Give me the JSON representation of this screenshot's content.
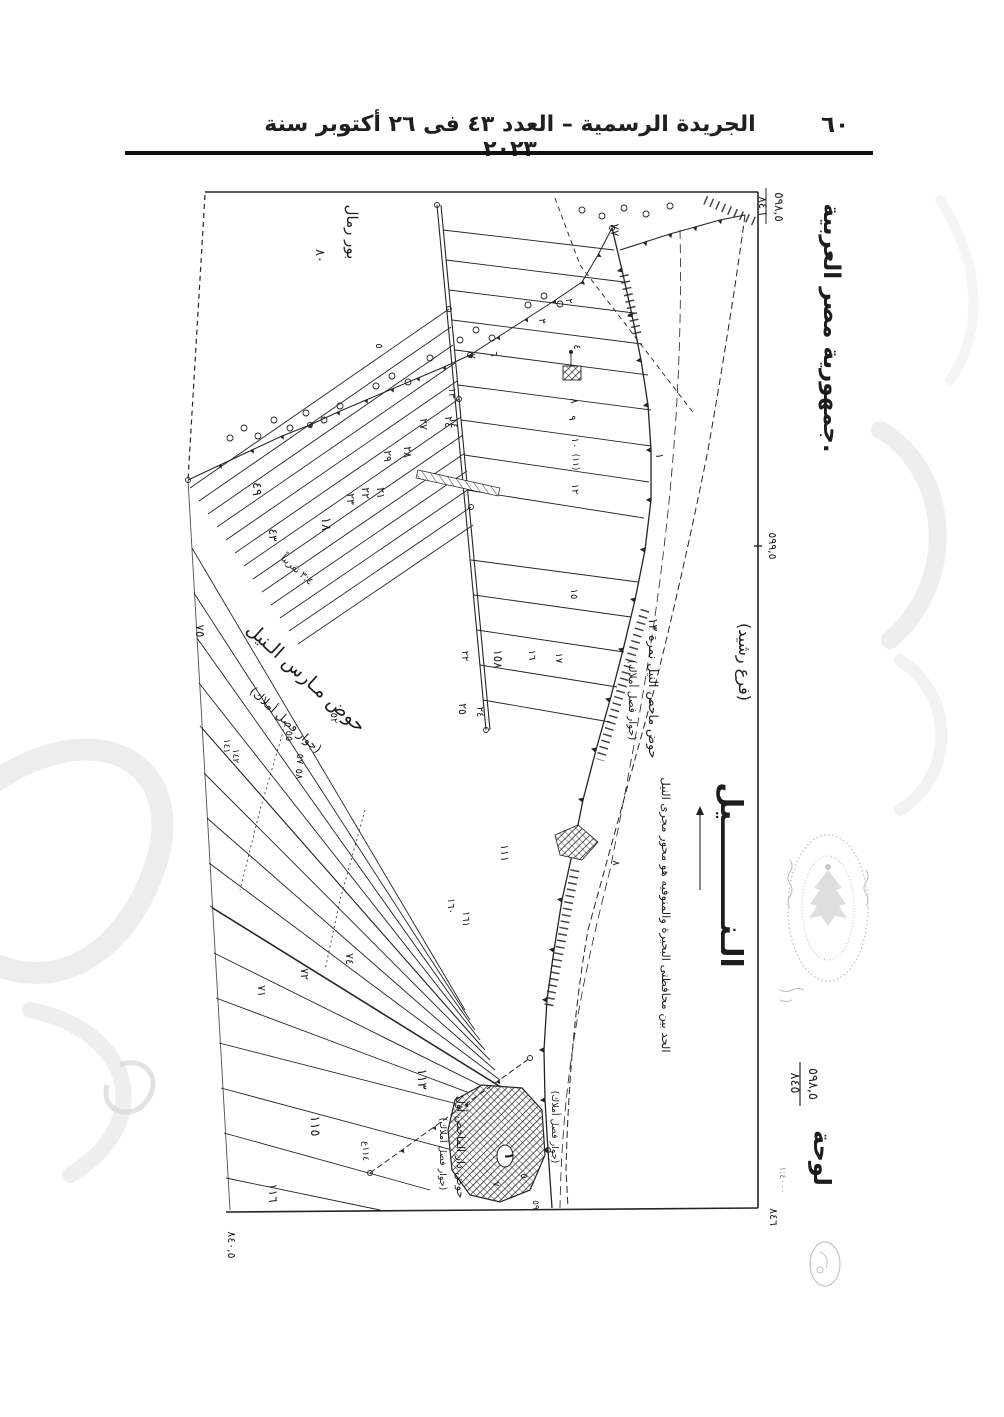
{
  "header": {
    "title": "الجريدة الرسمية – العدد ٤٣ فى ٢٦ أكتوبر سنة ٢٠٢٣",
    "page_number": "٦٠"
  },
  "map": {
    "ink_color": "#242424",
    "seal_color": "#9a9a9a",
    "watermark_color": "#dedede",
    "labels": [
      {
        "id": "country-label",
        "t": "جمهورية مصر العربية.",
        "x": 694,
        "y": 158,
        "s": 23,
        "b": 1
      },
      {
        "id": "sheet-ref-top-right-num",
        "t": "٨٤٦",
        "x": 629,
        "y": 36,
        "s": 12
      },
      {
        "id": "sheet-ref-top-right-den",
        "t": "٥٩٨,٥",
        "x": 645,
        "y": 37,
        "s": 12
      },
      {
        "id": "coord-right-mid",
        "t": "٥٩٩,٥",
        "x": 639,
        "y": 376,
        "s": 11
      },
      {
        "id": "sheet-ref-bottom-right-num",
        "t": "٨٤٥",
        "x": 661,
        "y": 913,
        "s": 13
      },
      {
        "id": "sheet-ref-bottom-right-den",
        "t": "٥٩٨,٥",
        "x": 679,
        "y": 914,
        "s": 13
      },
      {
        "id": "sheet-word",
        "t": "لوحة",
        "x": 684,
        "y": 988,
        "s": 24,
        "b": 1
      },
      {
        "id": "scale-note",
        "t": "١:٤٠٠٠",
        "x": 650,
        "y": 1010,
        "s": 9,
        "o": 0.5
      },
      {
        "id": "corner-ref-bottom",
        "t": "٨٤٦",
        "x": 640,
        "y": 1047,
        "s": 11
      },
      {
        "id": "coord-bottom-left",
        "t": "٨٤٠,٥",
        "x": 98,
        "y": 1075,
        "s": 11
      },
      {
        "id": "region-bour-remal",
        "t": "بور رمال",
        "x": 217,
        "y": 62,
        "s": 15
      },
      {
        "id": "parcel-number",
        "t": "٨٠",
        "x": 186,
        "y": 86,
        "s": 13
      },
      {
        "id": "parcel-number",
        "t": "٧٧",
        "x": 481,
        "y": 60,
        "s": 12
      },
      {
        "id": "nile-branch",
        "t": "(فرع رشيد)",
        "x": 609,
        "y": 492,
        "s": 16
      },
      {
        "id": "nile-name",
        "t": "الـنــــــــــيل",
        "x": 591,
        "y": 705,
        "s": 30,
        "b": 1
      },
      {
        "id": "governorate-boundary-note",
        "t": "الحد بين محافظتى البحيرة والمنوفيه هو محور مجرى النيل",
        "x": 532,
        "y": 745,
        "s": 11.5
      },
      {
        "id": "basin-mahas-label",
        "t": "حوض ماحص النيل نمرة ١٣",
        "x": 519,
        "y": 518,
        "s": 12.5
      },
      {
        "id": "easement-note",
        "t": "(جوار فصل أملاك)",
        "x": 499,
        "y": 530,
        "s": 10.5
      },
      {
        "id": "basin-mares-label",
        "t": "حوض مـارس الـنيل",
        "x": 172,
        "y": 512,
        "s": 19,
        "r": 42
      },
      {
        "id": "easement-note",
        "t": "(جوار فصل أملاك)",
        "x": 153,
        "y": 553,
        "s": 12,
        "r": 42
      },
      {
        "id": "ratio-note",
        "t": "٣:٤ تقريباً",
        "x": 165,
        "y": 402,
        "s": 10,
        "r": 42
      },
      {
        "id": "village-basin-label",
        "t": "حوض دار الماحص أول",
        "x": 327,
        "y": 977,
        "s": 11
      },
      {
        "id": "easement-note",
        "t": "(جوار فصل أملاك)",
        "x": 310,
        "y": 984,
        "s": 9.5
      },
      {
        "id": "easement-note",
        "t": "(جوار فصل أملاك)",
        "x": 422,
        "y": 957,
        "s": 9.5
      },
      {
        "id": "parcel-number",
        "t": "٢",
        "x": 436,
        "y": 131,
        "s": 10
      },
      {
        "id": "parcel-number",
        "t": "٣",
        "x": 409,
        "y": 151,
        "s": 10
      },
      {
        "id": "parcel-number",
        "t": "٤",
        "x": 444,
        "y": 177,
        "s": 10
      },
      {
        "id": "parcel-number",
        "t": "٥",
        "x": 246,
        "y": 176,
        "s": 10
      },
      {
        "id": "parcel-number",
        "t": "٦",
        "x": 361,
        "y": 184,
        "s": 10
      },
      {
        "id": "parcel-number",
        "t": "٧",
        "x": 339,
        "y": 186,
        "s": 10
      },
      {
        "id": "parcel-number",
        "t": "٨",
        "x": 441,
        "y": 231,
        "s": 10
      },
      {
        "id": "parcel-number",
        "t": "٩",
        "x": 439,
        "y": 248,
        "s": 10
      },
      {
        "id": "parcel-number",
        "t": "١٠",
        "x": 442,
        "y": 273,
        "s": 10
      },
      {
        "id": "parcel-number",
        "t": "(١١)",
        "x": 443,
        "y": 292,
        "s": 9
      },
      {
        "id": "parcel-number",
        "t": "١٢",
        "x": 442,
        "y": 319,
        "s": 10
      },
      {
        "id": "parcel-number",
        "t": "١٣",
        "x": 319,
        "y": 223,
        "s": 10
      },
      {
        "id": "parcel-number",
        "t": "١٤",
        "x": 321,
        "y": 253,
        "s": 10
      },
      {
        "id": "parcel-number",
        "t": "٢٧",
        "x": 290,
        "y": 254,
        "s": 11
      },
      {
        "id": "parcel-number",
        "t": "٢٤",
        "x": 315,
        "y": 252,
        "s": 11
      },
      {
        "id": "parcel-number",
        "t": "٢٩",
        "x": 254,
        "y": 286,
        "s": 11
      },
      {
        "id": "parcel-number",
        "t": "٢٨",
        "x": 274,
        "y": 282,
        "s": 11
      },
      {
        "id": "parcel-number",
        "t": "٢١",
        "x": 247,
        "y": 323,
        "s": 11
      },
      {
        "id": "parcel-number",
        "t": "٢٢",
        "x": 232,
        "y": 323,
        "s": 11
      },
      {
        "id": "parcel-number",
        "t": "٢٣",
        "x": 217,
        "y": 329,
        "s": 11
      },
      {
        "id": "parcel-number",
        "t": "١٨",
        "x": 192,
        "y": 354,
        "s": 13
      },
      {
        "id": "parcel-number",
        "t": "٤٩",
        "x": 123,
        "y": 319,
        "s": 13
      },
      {
        "id": "parcel-number",
        "t": "٤٣",
        "x": 139,
        "y": 365,
        "s": 12
      },
      {
        "id": "parcel-number",
        "t": "١٥",
        "x": 441,
        "y": 424,
        "s": 10
      },
      {
        "id": "parcel-number",
        "t": "١٦",
        "x": 399,
        "y": 485,
        "s": 10
      },
      {
        "id": "parcel-number",
        "t": "١٧",
        "x": 426,
        "y": 488,
        "s": 10
      },
      {
        "id": "parcel-number",
        "t": "١٥٨",
        "x": 364,
        "y": 489,
        "s": 12
      },
      {
        "id": "parcel-number",
        "t": "٢٢",
        "x": 332,
        "y": 486,
        "s": 10
      },
      {
        "id": "parcel-number",
        "t": "٢٥",
        "x": 329,
        "y": 539,
        "s": 11
      },
      {
        "id": "parcel-number",
        "t": "٢٤",
        "x": 347,
        "y": 542,
        "s": 10
      },
      {
        "id": "parcel-number",
        "t": "٧٥",
        "x": 66,
        "y": 461,
        "s": 12
      },
      {
        "id": "parcel-number",
        "t": "٥٢",
        "x": 201,
        "y": 548,
        "s": 10
      },
      {
        "id": "parcel-number",
        "t": "٥٥",
        "x": 156,
        "y": 566,
        "s": 10
      },
      {
        "id": "parcel-number",
        "t": "٥٧",
        "x": 167,
        "y": 589,
        "s": 10
      },
      {
        "id": "parcel-number",
        "t": "٥٨",
        "x": 166,
        "y": 604,
        "s": 10
      },
      {
        "id": "parcel-number",
        "t": "١٤١",
        "x": 94,
        "y": 576,
        "s": 9
      },
      {
        "id": "parcel-number",
        "t": "١٤٢",
        "x": 103,
        "y": 586,
        "s": 9
      },
      {
        "id": "parcel-number",
        "t": "١١١",
        "x": 371,
        "y": 683,
        "s": 11
      },
      {
        "id": "parcel-number",
        "t": "٨",
        "x": 483,
        "y": 693,
        "s": 10
      },
      {
        "id": "parcel-number",
        "t": "١",
        "x": 526,
        "y": 286,
        "s": 11
      },
      {
        "id": "parcel-number",
        "t": "١٦٠",
        "x": 318,
        "y": 736,
        "s": 10
      },
      {
        "id": "parcel-number",
        "t": "١٦١",
        "x": 333,
        "y": 749,
        "s": 10
      },
      {
        "id": "parcel-number",
        "t": "٧٤",
        "x": 216,
        "y": 789,
        "s": 11
      },
      {
        "id": "parcel-number",
        "t": "٧٢",
        "x": 171,
        "y": 804,
        "s": 11
      },
      {
        "id": "parcel-number",
        "t": "٧١",
        "x": 128,
        "y": 821,
        "s": 11
      },
      {
        "id": "parcel-number",
        "t": "١١٣",
        "x": 288,
        "y": 909,
        "s": 13
      },
      {
        "id": "parcel-number",
        "t": "١١٥",
        "x": 181,
        "y": 956,
        "s": 13
      },
      {
        "id": "parcel-number",
        "t": "١١٦",
        "x": 139,
        "y": 1023,
        "s": 12
      },
      {
        "id": "parcel-number",
        "t": "١١٤ع",
        "x": 233,
        "y": 981,
        "s": 9
      },
      {
        "id": "parcel-number",
        "t": "٥٩",
        "x": 403,
        "y": 1035,
        "s": 9
      },
      {
        "id": "village-number",
        "t": "١",
        "x": 375,
        "y": 986,
        "s": 12,
        "b": 1
      },
      {
        "id": "parcel-number",
        "t": "٥",
        "x": 391,
        "y": 1006,
        "s": 10
      },
      {
        "id": "parcel-number",
        "t": "٧",
        "x": 363,
        "y": 1014,
        "s": 10
      }
    ]
  }
}
